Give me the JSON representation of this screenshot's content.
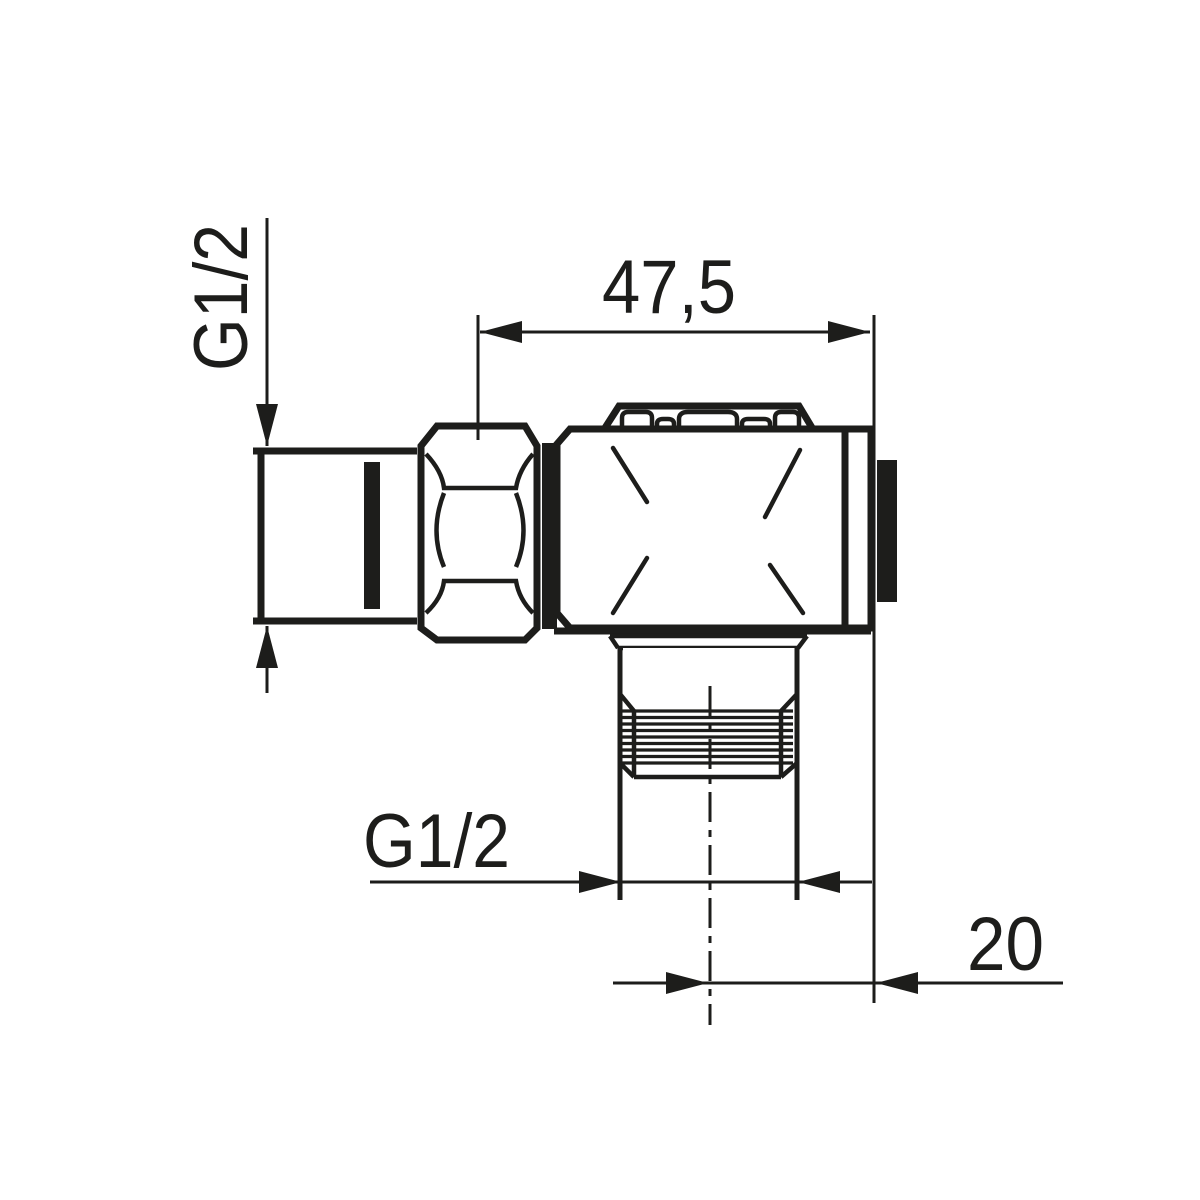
{
  "drawing": {
    "title": "angle-fitting-dimension-drawing",
    "background_color": "#ffffff",
    "line_color": "#1d1d1b",
    "labels": {
      "inlet_thread": "G1/2",
      "overall_width": "47,5",
      "outlet_thread": "G1/2",
      "outlet_offset": "20"
    }
  }
}
